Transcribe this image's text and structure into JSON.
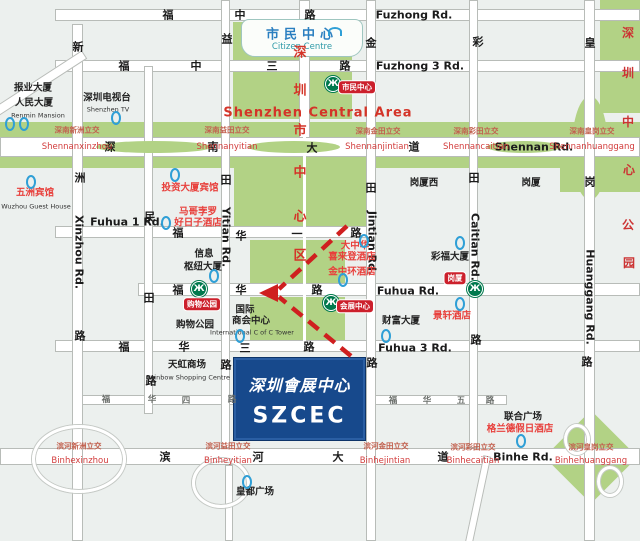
{
  "colors": {
    "szcec_blue": "#17498c",
    "map_green": "#b2d285",
    "metro_green": "#00794d",
    "badge_red": "#cc202c",
    "poi_red": "#e8403c",
    "arrow_red": "#cf1f1f",
    "building_blue": "#2f9fd6"
  },
  "icons": {
    "metro": "Ж"
  },
  "szcec": {
    "cn": "深圳會展中心",
    "en": "SZCEC"
  },
  "citizen": {
    "cn": "市民中心",
    "en": "Citizen Centre"
  },
  "central": {
    "en": "Shenzhen Central Area",
    "v": [
      "深",
      "圳",
      "市",
      "中",
      "心",
      "区"
    ]
  },
  "park": {
    "v": [
      "深",
      "圳",
      "中",
      "心",
      "公",
      "园"
    ]
  },
  "roads": {
    "fuzhong": {
      "cn": [
        "福",
        "中",
        "路"
      ],
      "en": "Fuzhong Rd."
    },
    "fuzhong3": {
      "cn": [
        "福",
        "中",
        "三",
        "路"
      ],
      "en": "Fuzhong 3 Rd."
    },
    "shennan": {
      "cn": [
        "深",
        "南",
        "大",
        "道"
      ],
      "en": "Shennan Rd."
    },
    "fuhua1": {
      "cn": [
        "福",
        "华",
        "一",
        "路"
      ],
      "en": "Fuhua 1 Rd."
    },
    "fuhua": {
      "cn": [
        "福",
        "华",
        "路"
      ],
      "en": "Fuhua Rd."
    },
    "fuhua3": {
      "cn": [
        "福",
        "华",
        "三",
        "路"
      ],
      "en": "Fuhua 3 Rd."
    },
    "fuhua4": {
      "cn": [
        "福",
        "华",
        "四",
        "路"
      ]
    },
    "fuhua5": {
      "cn": [
        "福",
        "华",
        "五",
        "路"
      ]
    },
    "binhe": {
      "cn": [
        "滨",
        "河",
        "大",
        "道"
      ],
      "en": "Binhe Rd."
    },
    "xinzhou": {
      "cn": [
        "新",
        "洲",
        "路"
      ],
      "en": "Xinzhou Rd."
    },
    "mintian": {
      "cn": [
        "民",
        "田",
        "路"
      ]
    },
    "yitian": {
      "cn": [
        "益",
        "田",
        "路"
      ],
      "en": "Yitian Rd."
    },
    "jintian": {
      "cn": [
        "金",
        "田",
        "路"
      ],
      "en": "Jintian Rd."
    },
    "caitian": {
      "cn": [
        "彩",
        "田",
        "路"
      ],
      "en": "Caitian Rd."
    },
    "huanggang": {
      "cn": [
        "皇",
        "岗",
        "路"
      ],
      "en": "Huanggang Rd."
    }
  },
  "interchanges": {
    "shennan_xinzhou": {
      "cn": "深南新洲立交",
      "en": "Shennanxinzhou"
    },
    "shennan_yitian": {
      "cn": "深南益田立交",
      "en": "Shennanyitian"
    },
    "shennan_jintian": {
      "cn": "深南金田立交",
      "en": "Shennanjintian"
    },
    "shennan_caitian": {
      "cn": "深南彩田立交",
      "en": "Shennancaitian"
    },
    "shennan_huanggang": {
      "cn": "深南皇岗立交",
      "en": "Shennanhuanggang"
    },
    "binhe_xinzhou": {
      "cn": "滨河新洲立交",
      "en": "Binhexinzhou"
    },
    "binhe_yitian": {
      "cn": "滨河益田立交",
      "en": "Binheyitian"
    },
    "binhe_jintian": {
      "cn": "滨河金田立交",
      "en": "Binhejintian"
    },
    "binhe_caitian": {
      "cn": "滨河彩田立交",
      "en": "Binhecaitian"
    },
    "binhe_huanggang": {
      "cn": "滨河皇岗立交",
      "en": "Binhehuanggang"
    }
  },
  "stations": {
    "shimin": "市民中心",
    "gouwu": "购物公园",
    "huizhan": "会展中心",
    "gangxia": "岗厦"
  },
  "districts": {
    "gangxia_west": "岗厦西",
    "gangxia": "岗厦"
  },
  "pois": {
    "baoye": "报业大厦",
    "renmin_cn": "人民大厦",
    "renmin_en": "Renmin Mansion",
    "tv_cn": "深圳电视台",
    "tv_en": "Shenzhen TV",
    "wuzhou_cn": "五洲宾馆",
    "wuzhou_en": "Wuzhou Guest House",
    "touzi": "投资大厦宾馆",
    "marco1": "马哥孛罗",
    "marco2": "好日子酒店",
    "xinxi1": "信息",
    "xinxi2": "枢纽大厦",
    "shoppark": "购物公园",
    "icc1": "国际",
    "icc2": "商会中心",
    "icc_en": "International C of C Tower",
    "rainbow_cn": "天虹商场",
    "rainbow_en": "Rainbow Shopping Centre",
    "gc1": "大中华",
    "gc2": "喜来登酒店",
    "jzh": "金中环酒店",
    "caifu": "彩福大厦",
    "jingxuan": "景轩酒店",
    "fortune": "财富大厦",
    "lianhe": "联合广场",
    "grand": "格兰德假日酒店",
    "huangdu": "皇都广场"
  }
}
